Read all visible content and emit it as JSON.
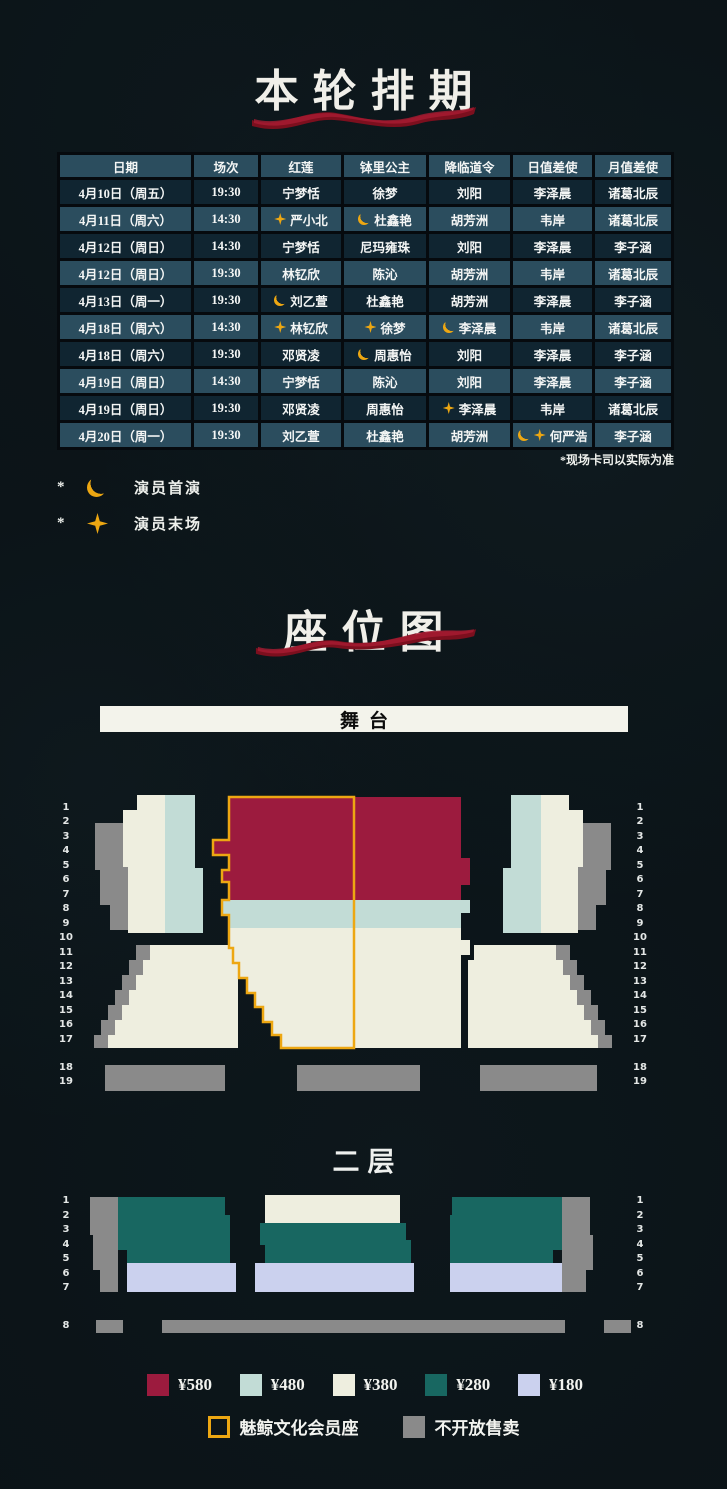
{
  "colors": {
    "p580": "#9c1b3e",
    "p480": "#c2dcd6",
    "p380": "#eeeedf",
    "p280": "#186761",
    "p180": "#cbd1ee",
    "member": "#eda712",
    "unavailable": "#8a8a8a",
    "ribbon": "#8e1426"
  },
  "schedule": {
    "title": "本轮排期",
    "note": "*现场卡司以实际为准",
    "columns": [
      "日期",
      "场次",
      "红莲",
      "钵里公主",
      "降临道令",
      "日值差使",
      "月值差使"
    ],
    "rows": [
      [
        {
          "t": "4月10日（周五）"
        },
        {
          "t": "19:30"
        },
        {
          "t": "宁梦恬"
        },
        {
          "t": "徐梦"
        },
        {
          "t": "刘阳"
        },
        {
          "t": "李泽晨"
        },
        {
          "t": "诸葛北辰"
        }
      ],
      [
        {
          "t": "4月11日（周六）"
        },
        {
          "t": "14:30"
        },
        {
          "t": "严小北",
          "ic": [
            "star"
          ]
        },
        {
          "t": "杜鑫艳",
          "ic": [
            "moon"
          ]
        },
        {
          "t": "胡芳洲"
        },
        {
          "t": "韦岸"
        },
        {
          "t": "诸葛北辰"
        }
      ],
      [
        {
          "t": "4月12日（周日）"
        },
        {
          "t": "14:30"
        },
        {
          "t": "宁梦恬"
        },
        {
          "t": "尼玛雍珠"
        },
        {
          "t": "刘阳"
        },
        {
          "t": "李泽晨"
        },
        {
          "t": "李子涵"
        }
      ],
      [
        {
          "t": "4月12日（周日）"
        },
        {
          "t": "19:30"
        },
        {
          "t": "林钇欣"
        },
        {
          "t": "陈沁"
        },
        {
          "t": "胡芳洲"
        },
        {
          "t": "韦岸"
        },
        {
          "t": "诸葛北辰"
        }
      ],
      [
        {
          "t": "4月13日（周一）"
        },
        {
          "t": "19:30"
        },
        {
          "t": "刘乙萱",
          "ic": [
            "moon"
          ]
        },
        {
          "t": "杜鑫艳"
        },
        {
          "t": "胡芳洲"
        },
        {
          "t": "李泽晨"
        },
        {
          "t": "李子涵"
        }
      ],
      [
        {
          "t": "4月18日（周六）"
        },
        {
          "t": "14:30"
        },
        {
          "t": "林钇欣",
          "ic": [
            "star"
          ]
        },
        {
          "t": "徐梦",
          "ic": [
            "star"
          ]
        },
        {
          "t": "李泽晨",
          "ic": [
            "moon"
          ]
        },
        {
          "t": "韦岸"
        },
        {
          "t": "诸葛北辰"
        }
      ],
      [
        {
          "t": "4月18日（周六）"
        },
        {
          "t": "19:30"
        },
        {
          "t": "邓贤凌"
        },
        {
          "t": "周惠怡",
          "ic": [
            "moon"
          ]
        },
        {
          "t": "刘阳"
        },
        {
          "t": "李泽晨"
        },
        {
          "t": "李子涵"
        }
      ],
      [
        {
          "t": "4月19日（周日）"
        },
        {
          "t": "14:30"
        },
        {
          "t": "宁梦恬"
        },
        {
          "t": "陈沁"
        },
        {
          "t": "刘阳"
        },
        {
          "t": "李泽晨"
        },
        {
          "t": "李子涵"
        }
      ],
      [
        {
          "t": "4月19日（周日）"
        },
        {
          "t": "19:30"
        },
        {
          "t": "邓贤凌"
        },
        {
          "t": "周惠怡"
        },
        {
          "t": "李泽晨",
          "ic": [
            "star"
          ]
        },
        {
          "t": "韦岸"
        },
        {
          "t": "诸葛北辰"
        }
      ],
      [
        {
          "t": "4月20日（周一）"
        },
        {
          "t": "19:30"
        },
        {
          "t": "刘乙萱"
        },
        {
          "t": "杜鑫艳"
        },
        {
          "t": "胡芳洲"
        },
        {
          "t": "何严浩",
          "ic": [
            "moon",
            "star"
          ]
        },
        {
          "t": "李子涵"
        }
      ]
    ],
    "icon_legend": [
      {
        "prefix": "*",
        "icon": "moon",
        "label": "演员首演"
      },
      {
        "prefix": "*",
        "icon": "star",
        "label": "演员末场"
      }
    ]
  },
  "seatmap": {
    "title": "座位图",
    "stage_label": "舞台",
    "floor2_label": "二层",
    "floor1_rows": [
      "1",
      "2",
      "3",
      "4",
      "5",
      "6",
      "7",
      "8",
      "9",
      "10",
      "11",
      "12",
      "13",
      "14",
      "15",
      "16",
      "17",
      "18",
      "19"
    ],
    "floor2_rows": [
      "1",
      "2",
      "3",
      "4",
      "5",
      "6",
      "7",
      "8"
    ],
    "price_legend": [
      {
        "label": "¥580",
        "color_key": "p580"
      },
      {
        "label": "¥480",
        "color_key": "p480"
      },
      {
        "label": "¥380",
        "color_key": "p380"
      },
      {
        "label": "¥280",
        "color_key": "p280"
      },
      {
        "label": "¥180",
        "color_key": "p180"
      }
    ],
    "special_legend": [
      {
        "label": "魅鲸文化会员座",
        "type": "member"
      },
      {
        "label": "不开放售卖",
        "type": "unavailable"
      }
    ]
  }
}
